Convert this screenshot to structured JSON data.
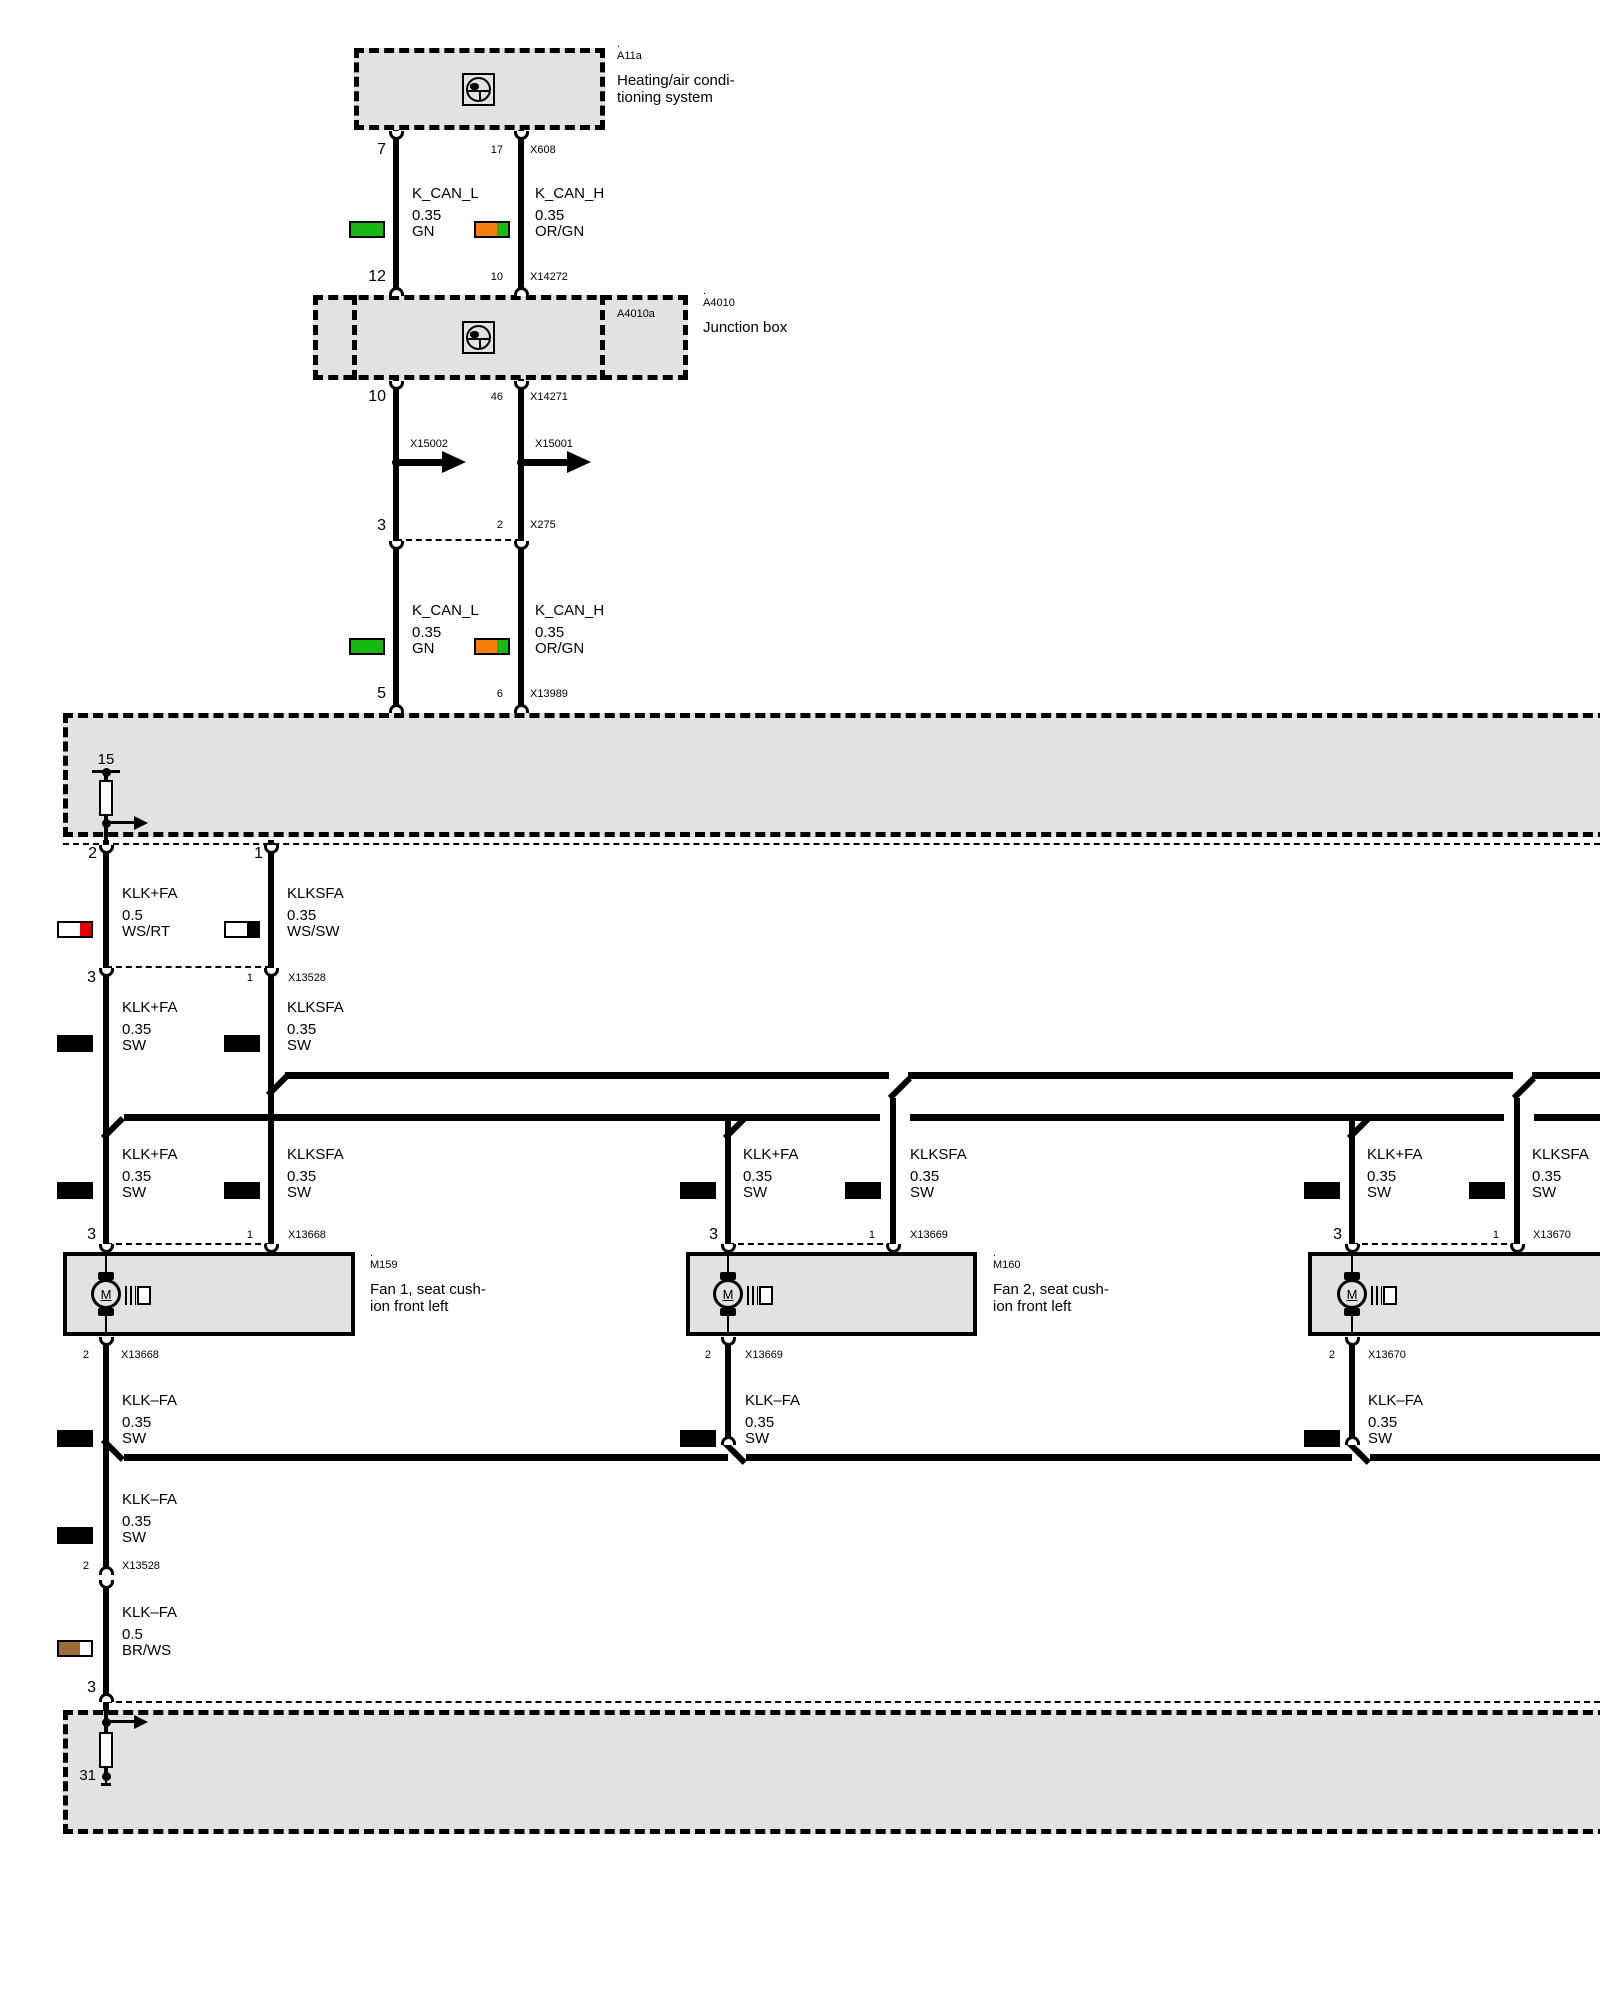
{
  "colors": {
    "fill": "#e2e2e2",
    "green": "#17b812",
    "orange": "#f57d0c",
    "red": "#e60000",
    "brown": "#9c6b39"
  },
  "hvac": {
    "dot": ".",
    "id": "A11a",
    "desc1": "Heating/air condi-",
    "desc2": "tioning system"
  },
  "jb": {
    "dot": ".",
    "id": "A4010",
    "inner_id": "A4010a",
    "desc": "Junction box"
  },
  "rows": {
    "x608": {
      "pin_l": "7",
      "pin_r": "17",
      "conn": "X608"
    },
    "x14272": {
      "pin_l": "12",
      "pin_r": "10",
      "conn": "X14272"
    },
    "x14271": {
      "pin_l": "10",
      "pin_r": "46",
      "conn": "X14271"
    },
    "x275": {
      "pin_l": "3",
      "pin_r": "2",
      "conn": "X275"
    },
    "x13989": {
      "pin_l": "5",
      "pin_r": "6",
      "conn": "X13989"
    },
    "box1": {
      "pin_l": "2",
      "pin_r": "1"
    },
    "x13528": {
      "pin_l": "3",
      "pin_r": "1",
      "conn": "X13528"
    },
    "x13528b": {
      "pin": "2",
      "conn": "X13528",
      "pin_below": "3"
    }
  },
  "plugs": {
    "left": "X15002",
    "right": "X15001"
  },
  "can": {
    "l": {
      "name": "K_CAN_L",
      "gauge": "0.35",
      "color": "GN"
    },
    "r": {
      "name": "K_CAN_H",
      "gauge": "0.35",
      "color": "OR/GN"
    }
  },
  "seg1": {
    "l": {
      "name": "KLK+FA",
      "gauge": "0.5",
      "color": "WS/RT"
    },
    "r": {
      "name": "KLKSFA",
      "gauge": "0.35",
      "color": "WS/SW"
    }
  },
  "feed": {
    "l": {
      "name": "KLK+FA",
      "gauge": "0.35",
      "color": "SW"
    },
    "r": {
      "name": "KLKSFA",
      "gauge": "0.35",
      "color": "SW"
    }
  },
  "ret": {
    "name": "KLK–FA",
    "gauge": "0.35",
    "color": "SW"
  },
  "gnd_wire": {
    "name": "KLK–FA",
    "gauge": "0.5",
    "color": "BR/WS"
  },
  "terminals": {
    "plus": "15",
    "ground": "31"
  },
  "motor_letter": "M",
  "fans": {
    "f1": {
      "dot": ".",
      "id": "M159",
      "desc1": "Fan 1, seat cush-",
      "desc2": "ion front left",
      "pin_l": "3",
      "pin_r": "1",
      "conn": "X13668",
      "pin_b": "2"
    },
    "f2": {
      "dot": ".",
      "id": "M160",
      "desc1": "Fan 2, seat cush-",
      "desc2": "ion front left",
      "pin_l": "3",
      "pin_r": "1",
      "conn": "X13669",
      "pin_b": "2"
    },
    "f3": {
      "pin_l": "3",
      "pin_r": "1",
      "conn": "X13670",
      "pin_b": "2"
    }
  }
}
